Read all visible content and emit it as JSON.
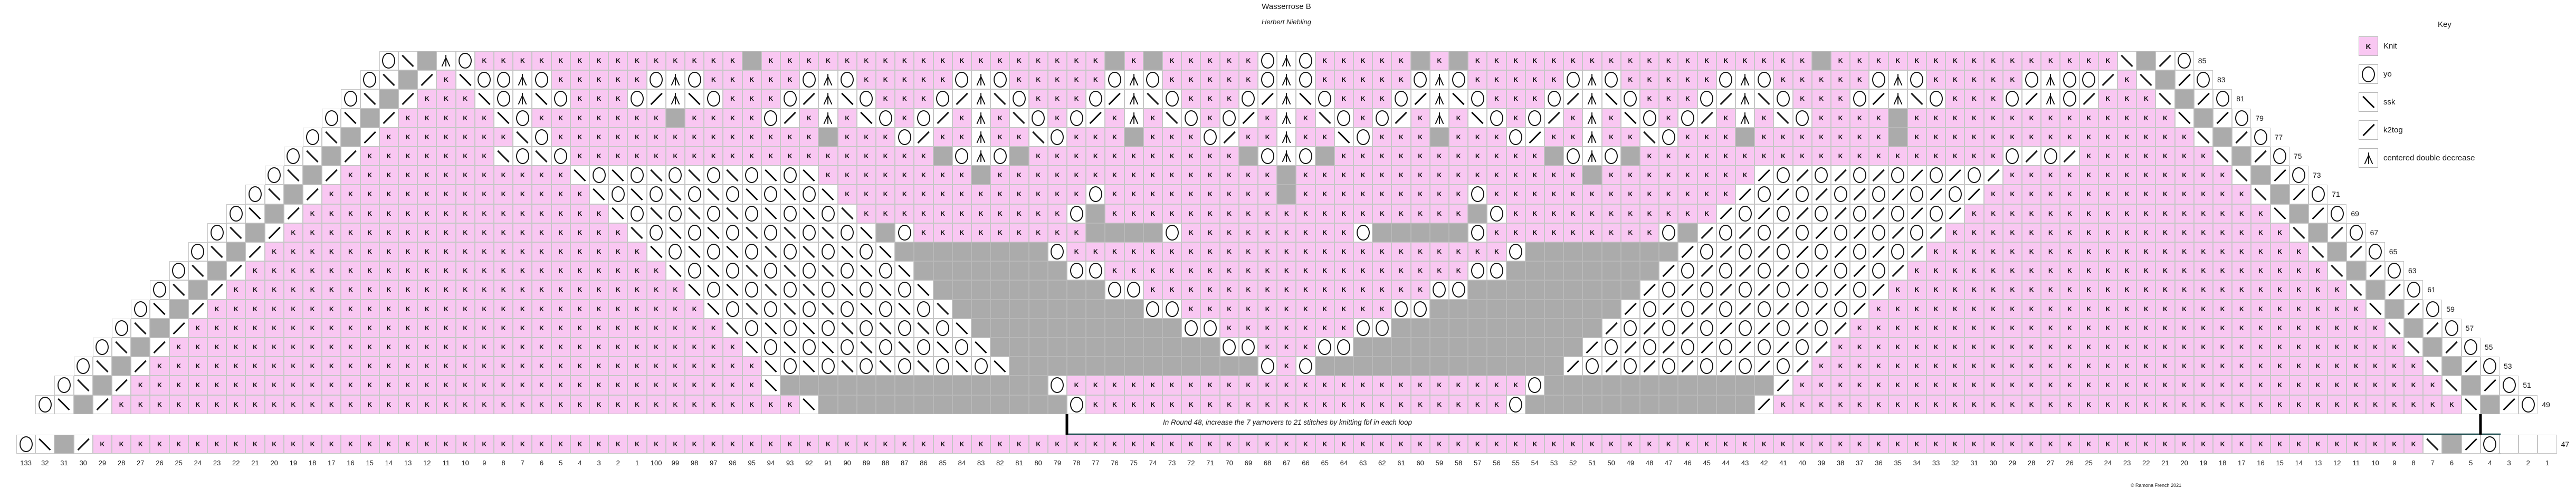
{
  "title": "Wasserrose B",
  "subtitle": "Herbert Niebling",
  "note": "In Round 48, increase the 7 yarnovers to 21 stitches by knitting fbf in each loop",
  "copyright": "© Ramona French 2021",
  "key": {
    "title": "Key",
    "items": [
      {
        "symbol": "K",
        "label": "Knit"
      },
      {
        "symbol": "O",
        "label": "yo"
      },
      {
        "symbol": "S",
        "label": "ssk"
      },
      {
        "symbol": "Z",
        "label": "k2tog"
      },
      {
        "symbol": "A",
        "label": "centered double decrease"
      }
    ]
  },
  "colors": {
    "knit": "#f9c7f2",
    "no_stitch": "#ababab",
    "repeat_line": "#17494b",
    "marker_line": "#000000",
    "grid": "#c6c6c6"
  },
  "chart_data": {
    "type": "heatmap",
    "title": "Wasserrose B lace knitting chart",
    "columns": 133,
    "legend_position": "top-right",
    "symbol_meanings": {
      "K": "Knit",
      "O": "yo",
      "S": "ssk",
      "Z": "k2tog",
      "A": "centered double decrease",
      "_": "no stitch",
      ".": "outside chart"
    },
    "rows": [
      {
        "round": "85",
        "last": 114,
        "cells": "...................OS_AOKKKKKKKKKKKKKK_KKKKKKKKKKKKKKKKKK_K_KKKKKOAOKKKKK_K_KKKKKKKKKKKKKKKKKK_KKKKKKKKKKKKKKKS_ZO..................."
      },
      {
        "round": "83",
        "last": 115,
        "cells": "..................OS_ZKSOOAOKKKKKOAOKKKKKOAOKKKKKOAOKKKKKOAOKKKKKOAOKKKKKOAOKKKKKOAOKKKKKOAOKKKKKOAOKKKKKOAOOZKS_ZO.................."
      },
      {
        "round": "81",
        "last": 116,
        "cells": ".................OS_ZKKKSOASOKKKOZASOKKKOZASOKKKOZASOKKKOZASOKKKOZASOKKKOZASOKKKOZASOKKKOZASOKKKOZASOKKKOZAOZKKKS_ZO................."
      },
      {
        "round": "79",
        "last": 117,
        "cells": "................OS_ZKKKKKSOKKKKKKK_KKKKOZKAKSOKOZKAKSOKOZKAKSOKOZKAKSOKOZKAKSOKOZKAKSOKOZKAKSOKKKK_KKKKKKKKKKKKKKS_ZO................"
      },
      {
        "round": "77",
        "last": 118,
        "cells": "...............OS_ZKKKKKKKSOKKKKKKKKKKKKKK_KKKOZKKAKKSOKKK_KKKOZKKAKKSOKKK_KKKOZKKAKKSOKKK_KKKKKKK_KKKKKKKKKKKKKKKS_ZO..............."
      },
      {
        "round": "75",
        "last": 119,
        "cells": "..............OS_ZKKKKKKKSOSOKKKKKKKKKKKKKKKKKKK_OAO_KKKKKKKKKKK_OAO_KKKKKKKKKKK_OAO_KKKKKKKKKKKKKKKKKKKOZOZKKKKKKKS_ZO.............."
      },
      {
        "round": "73",
        "last": 120,
        "cells": ".............OS_ZKKKKKKKKKKKKSOSOSOSOSOSOSKKKKKKKK_KKKKKKKKKKKKKKK_KKKKKKKKKKKKKKK_KKKKKKKKZOZOZOZOZOZOZKKKKKKKKKKKKS_ZO............."
      },
      {
        "round": "71",
        "last": 121,
        "cells": "............OS_ZKKKKKKKKKKKKKKSOSOSOSOSOSOSKKKKKKKKKKKKKOKKKKKKKKK_KKKKKKKKKOKKKKKKKKKKKKKZOZOZOZOZOZOZKKKKKKKKKKKKKKS_ZO............"
      },
      {
        "round": "69",
        "last": 122,
        "cells": "...........OS_ZKKKKKKKKKKKKKKKKSOSOSOSOSOSOSKKKKKKKKKKKO_KKKKKKKKKKKKKKKKKKK_OKKKKKKKKKKKZOZOZOZOZOZOZKKKKKKKKKKKKKKKKS_ZO..........."
      },
      {
        "round": "67",
        "last": 123,
        "cells": "..........OS_ZKKKKKKKKKKKKKKKKKKSOSOSOSOSOSOS_OKKKKKKKKK____OKKKKKKKKKO_____OKKKKKKKKKO_ZOZOZOZOZOZOZKKKKKKKKKKKKKKKKKKS_ZO.........."
      },
      {
        "round": "65",
        "last": 124,
        "cells": ".........OS_ZKKKKKKKKKKKKKKKKKKKKSOSOSOSOSOSOS________OKKKKKKKKKKKKKKKKKKKKKKKO________ZOZOZOZOZOZOZKKKKKKKKKKKKKKKKKKKKS_ZO........."
      },
      {
        "round": "63",
        "last": 125,
        "cells": "........OS_ZKKKKKKKKKKKKKKKKKKKKKKSOSOSOSOSOSOS________OOKKKKKKKKKKKKKKKKKKKOO________ZOZOZOZOZOZOZKKKKKKKKKKKKKKKKKKKKKKS_ZO........"
      },
      {
        "round": "61",
        "last": 126,
        "cells": ".......OS_ZKKKKKKKKKKKKKKKKKKKKKKKKSOSOSOSOSOSOS_________OOKKKKKKKKKKKKKKKOO_________ZOZOZOZOZOZOZKKKKKKKKKKKKKKKKKKKKKKKKS_ZO......."
      },
      {
        "round": "59",
        "last": 127,
        "cells": "......OS_ZKKKKKKKKKKKKKKKKKKKKKKKKKKSOSOSOSOSOSOS__________OOKKKKKKKKKKKOO__________ZOZOZOZOZOZOZKKKKKKKKKKKKKKKKKKKKKKKKKKS_ZO......"
      },
      {
        "round": "57",
        "last": 128,
        "cells": ".....OS_ZKKKKKKKKKKKKKKKKKKKKKKKKKKKKSOSOSOSOSOSOS___________OOKKKKKKKOO___________ZOZOZOZOZOZOZKKKKKKKKKKKKKKKKKKKKKKKKKKKKS_ZO....."
      },
      {
        "round": "55",
        "last": 129,
        "cells": "....OS_ZKKKKKKKKKKKKKKKKKKKKKKKKKKKKKKSOSOSOSOSOSOS____________OOKKKOO____________ZOZOZOZOZOZOZKKKKKKKKKKKKKKKKKKKKKKKKKKKKKKS_ZO...."
      },
      {
        "round": "53",
        "last": 130,
        "cells": "...OS_ZKKKKKKKKKKKKKKKKKKKKKKKKKKKKKKKKSOSOSOSOSOSOS_____________OKO_____________ZOZOZOZOZOZOZKKKKKKKKKKKKKKKKKKKKKKKKKKKKKKKKS_ZO..."
      },
      {
        "round": "51",
        "last": 131,
        "cells": "..OS_ZKKKKKKKKKKKKKKKKKKKKKKKKKKKKKKKKKS______________OKKKKKKKKKKKKKKKKKKKKKKKKO____________ZKKKKKKKKKKKKKKKKKKKKKKKKKKKKKKKKKKS_ZO.."
      },
      {
        "round": "49",
        "last": 132,
        "cells": ".OS_ZKKKKKKKKKKKKKKKKKKKKKKKKKKKKKKKKKKKKS_____________OKKKKKKKKKKKKKKKKKKKKKKO____________ZKKKKKKKKKKKKKKKKKKKKKKKKKKKKKKKKKKKKS_ZO."
      },
      {
        "round": "47",
        "last": 133,
        "band": true,
        "cells": "OS_ZKKKKKKKKKKKKKKKKKKKKKKKKKKKKKKKKKKKKKKKKKKKKKKKKKKKKKKKKKKKKKKKKKKKKKKKKKKKKKKKKKKKKKKKKKKKKKKKKKKKKKKKKKKKKKKKKKKKKKKKKKKS_ZO"
      }
    ],
    "col_labels": [
      "133",
      "32",
      "31",
      "30",
      "29",
      "28",
      "27",
      "26",
      "25",
      "24",
      "23",
      "22",
      "21",
      "20",
      "19",
      "18",
      "17",
      "16",
      "15",
      "14",
      "13",
      "12",
      "11",
      "10",
      "9",
      "8",
      "7",
      "6",
      "5",
      "4",
      "3",
      "2",
      "1",
      "100",
      "99",
      "98",
      "97",
      "96",
      "95",
      "94",
      "93",
      "92",
      "91",
      "90",
      "89",
      "88",
      "87",
      "86",
      "85",
      "84",
      "83",
      "82",
      "81",
      "80",
      "79",
      "78",
      "77",
      "76",
      "75",
      "74",
      "73",
      "72",
      "71",
      "70",
      "69",
      "68",
      "67",
      "66",
      "65",
      "64",
      "63",
      "62",
      "61",
      "60",
      "59",
      "58",
      "57",
      "56",
      "55",
      "54",
      "53",
      "52",
      "51",
      "50",
      "49",
      "48",
      "47",
      "46",
      "45",
      "44",
      "43",
      "42",
      "41",
      "40",
      "39",
      "38",
      "37",
      "36",
      "35",
      "34",
      "33",
      "32",
      "31",
      "30",
      "29",
      "28",
      "27",
      "26",
      "25",
      "24",
      "23",
      "22",
      "21",
      "20",
      "19",
      "18",
      "17",
      "16",
      "15",
      "14",
      "13",
      "12",
      "11",
      "10",
      "9",
      "8",
      "7",
      "6",
      "5",
      "4",
      "3",
      "2",
      "1"
    ],
    "row_labels": [
      "85",
      "83",
      "81",
      "79",
      "77",
      "75",
      "73",
      "71",
      "69",
      "67",
      "65",
      "63",
      "61",
      "59",
      "57",
      "55",
      "53",
      "51",
      "49",
      "47"
    ]
  },
  "repeat_lines": [
    {
      "color": "repeat_line",
      "width": 4.5,
      "points": [
        [
          864,
          97
        ],
        [
          864,
          133
        ],
        [
          900,
          133
        ],
        [
          900,
          169
        ],
        [
          936,
          169
        ],
        [
          936,
          206
        ],
        [
          972,
          206
        ],
        [
          972,
          242
        ],
        [
          1008,
          242
        ],
        [
          1008,
          278
        ],
        [
          1045,
          278
        ],
        [
          1045,
          314
        ],
        [
          1081,
          314
        ],
        [
          1081,
          350
        ],
        [
          1117,
          350
        ],
        [
          1117,
          387
        ],
        [
          1153,
          387
        ],
        [
          1153,
          423
        ],
        [
          1189,
          423
        ],
        [
          1189,
          459
        ],
        [
          1226,
          459
        ],
        [
          1226,
          495
        ],
        [
          1262,
          495
        ],
        [
          1262,
          531
        ],
        [
          1298,
          531
        ],
        [
          1298,
          568
        ],
        [
          1334,
          568
        ],
        [
          1334,
          604
        ],
        [
          1370,
          604
        ],
        [
          1370,
          640
        ],
        [
          1407,
          640
        ],
        [
          1407,
          676
        ],
        [
          1443,
          676
        ],
        [
          1443,
          712
        ],
        [
          2022,
          712
        ],
        [
          2022,
          785
        ]
      ]
    },
    {
      "color": "repeat_line",
      "width": 4.5,
      "points": [
        [
          4049,
          97
        ],
        [
          4049,
          133
        ],
        [
          4085,
          133
        ],
        [
          4085,
          169
        ],
        [
          4122,
          169
        ],
        [
          4122,
          206
        ],
        [
          4158,
          206
        ],
        [
          4158,
          242
        ],
        [
          4194,
          242
        ],
        [
          4194,
          278
        ],
        [
          4230,
          278
        ],
        [
          4230,
          314
        ],
        [
          4266,
          314
        ],
        [
          4266,
          350
        ],
        [
          4303,
          350
        ],
        [
          4303,
          387
        ],
        [
          4339,
          387
        ],
        [
          4339,
          423
        ],
        [
          4375,
          423
        ],
        [
          4375,
          459
        ],
        [
          4411,
          459
        ],
        [
          4411,
          495
        ],
        [
          4447,
          495
        ],
        [
          4447,
          531
        ],
        [
          4484,
          531
        ],
        [
          4484,
          568
        ],
        [
          4520,
          568
        ],
        [
          4520,
          604
        ],
        [
          4556,
          604
        ],
        [
          4556,
          640
        ],
        [
          4592,
          640
        ],
        [
          4592,
          676
        ],
        [
          4628,
          676
        ],
        [
          4628,
          712
        ],
        [
          4665,
          712
        ],
        [
          4665,
          749
        ],
        [
          4701,
          749
        ],
        [
          4701,
          785
        ]
      ]
    },
    {
      "color": "repeat_line",
      "width": 4.5,
      "points": [
        [
          2022,
          824
        ],
        [
          4737,
          824
        ],
        [
          4737,
          861
        ]
      ]
    },
    {
      "color": "marker_line",
      "width": 5,
      "points": [
        [
          2022,
          785
        ],
        [
          2022,
          824
        ]
      ]
    },
    {
      "color": "marker_line",
      "width": 5,
      "points": [
        [
          4701,
          785
        ],
        [
          4701,
          824
        ]
      ]
    }
  ]
}
